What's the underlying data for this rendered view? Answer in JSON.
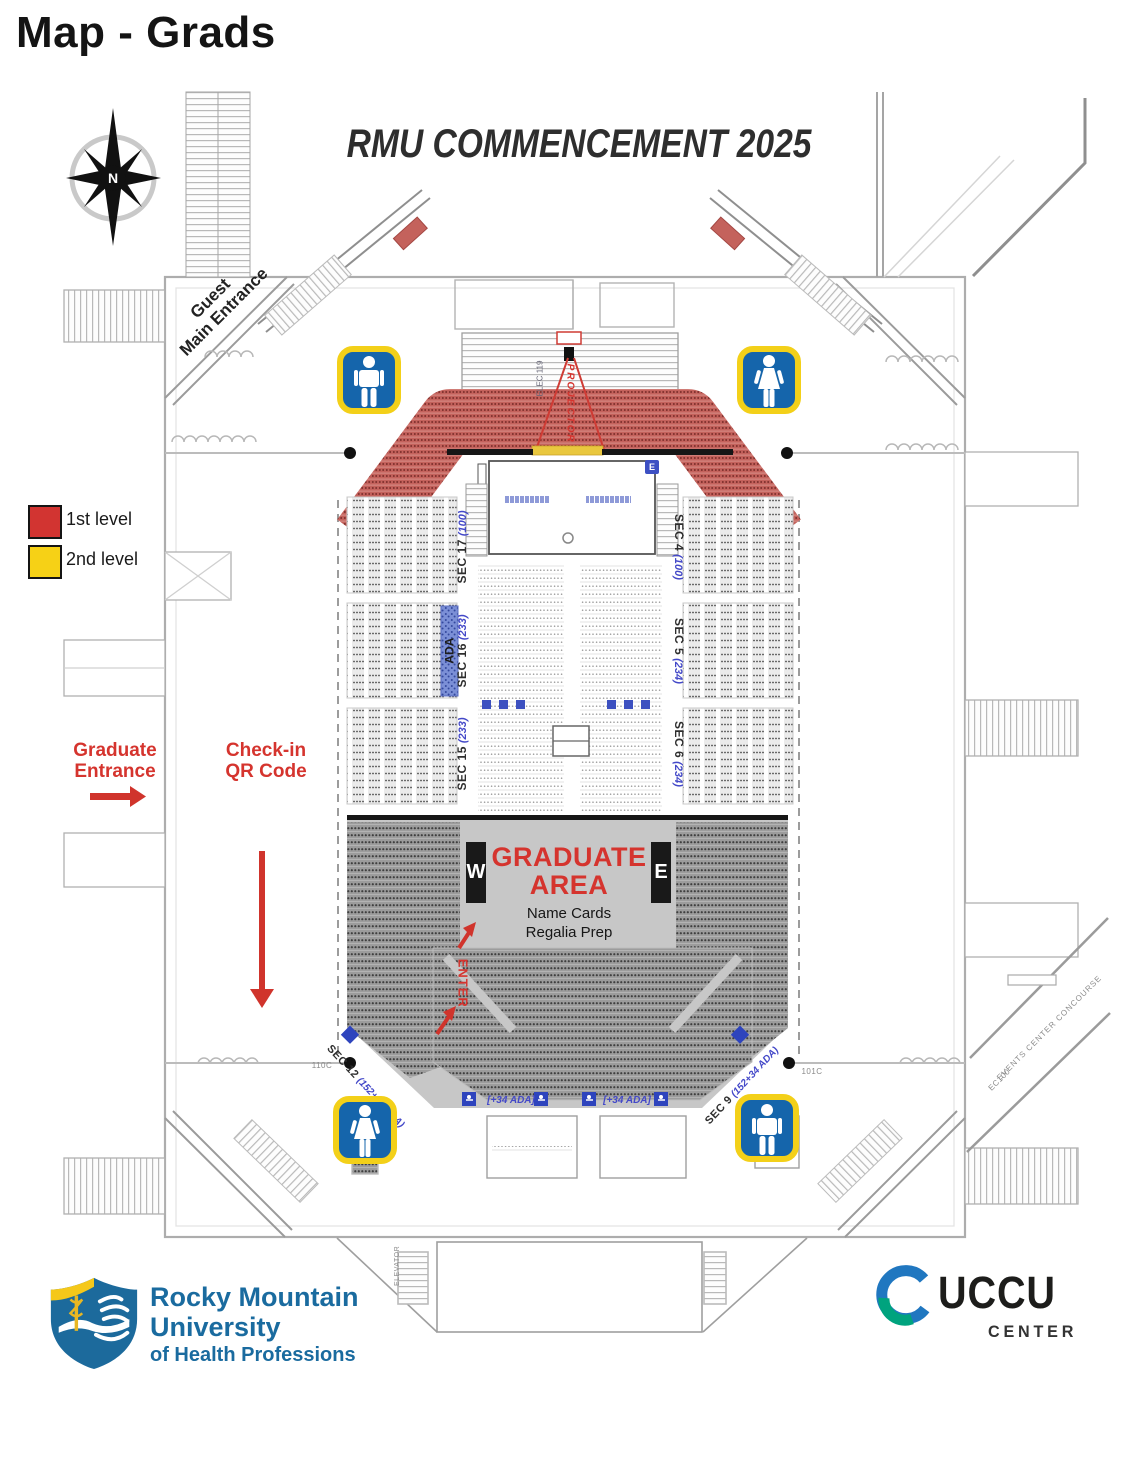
{
  "page": {
    "title": "Map - Grads"
  },
  "map": {
    "event_title": "RMU COMMENCEMENT 2025",
    "compass_label": "N",
    "guest_entrance": {
      "line1": "Guest",
      "line2": "Main Entrance"
    },
    "legend": [
      {
        "label": "1st level",
        "color": "#d23431"
      },
      {
        "label": "2nd level",
        "color": "#f6d116"
      }
    ],
    "graduate_entrance": {
      "line1": "Graduate",
      "line2": "Entrance"
    },
    "check_in": {
      "line1": "Check-in",
      "line2": "QR Code"
    },
    "projector_label": "PROJECTOR",
    "stage_badge": "E",
    "ada_label": "ADA",
    "graduate_area": {
      "title_line1": "GRADUATE",
      "title_line2": "AREA",
      "note_line1": "Name Cards",
      "note_line2": "Regalia Prep",
      "west_box": "W",
      "east_box": "E",
      "enter_label": "ENTER"
    },
    "sections": {
      "left": [
        {
          "name": "SEC 17",
          "capacity": "(100)"
        },
        {
          "name": "SEC 16",
          "capacity": "(233)"
        },
        {
          "name": "SEC 15",
          "capacity": "(233)"
        }
      ],
      "right": [
        {
          "name": "SEC 4",
          "capacity": "(100)"
        },
        {
          "name": "SEC 5",
          "capacity": "(234)"
        },
        {
          "name": "SEC 6",
          "capacity": "(234)"
        }
      ],
      "bottom_left": {
        "name": "SEC 12",
        "capacity": "(152+34 ADA)"
      },
      "bottom_right": {
        "name": "SEC 9",
        "capacity": "(152+34 ADA)"
      }
    },
    "floor_ada_labels": [
      "[+34 ADA]",
      "[+34 ADA]"
    ],
    "rooms": {
      "elec": "ELEC 119",
      "room_left": "110C",
      "room_right": "101C",
      "elevator": "ELEVATOR",
      "concourse": "EVENTS CENTER CONCOURSE",
      "concourse_code": "EC100"
    }
  },
  "footer": {
    "rmu": {
      "line1": "Rocky Mountain",
      "line2": "University",
      "line3": "of Health Professions"
    },
    "uccu": {
      "name": "UCCU",
      "subtitle": "CENTER"
    }
  },
  "colors": {
    "level1_red": "#d23431",
    "level2_yellow": "#f6d116",
    "accent_red": "#d5342e",
    "seat_red": "#c4625c",
    "restroom_blue": "#1565ab",
    "restroom_border": "#f3d019",
    "ada_blue": "#4348c8",
    "rmu_blue": "#1a6b9f",
    "uccu_blue": "#2077c0",
    "uccu_green": "#00a37e"
  }
}
